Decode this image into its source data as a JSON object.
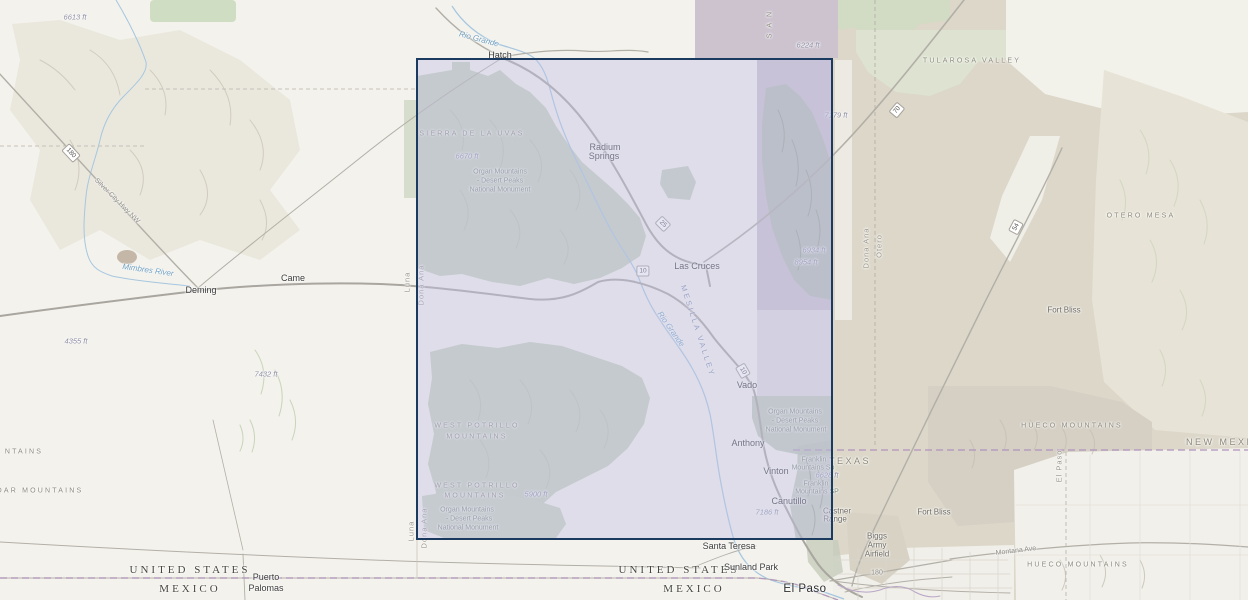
{
  "colors": {
    "selection_border": "#1b3a5f",
    "selection_fill": "rgba(192,192,229,0.42)",
    "label_city": "#3c3c3c",
    "label_country": "#47463e",
    "label_state": "#8d8779",
    "label_range": "#8d897c",
    "label_water": "#6f9fc0",
    "label_elev": "#8f8fa6",
    "label_park": "#7c8973",
    "label_county": "#9b978d",
    "road_gray": "#b2afa7",
    "boundary_purple": "#b195bd",
    "water_blue": "#a6c6e0"
  },
  "selection": {
    "x": 416,
    "y": 58,
    "width": 417,
    "height": 482
  },
  "map": {
    "labels": [
      {
        "text": "6613 ft",
        "x": 75,
        "y": 17,
        "cls": "elev",
        "name": "elevation-6613"
      },
      {
        "text": "180",
        "x": 71,
        "y": 153,
        "rot": 47,
        "cls": "shield",
        "name": "route-shield-180"
      },
      {
        "text": "Silver City Hwy NW",
        "x": 117,
        "y": 201,
        "rot": 45,
        "cls": "roadlbl",
        "name": "road-label-silver-city-hwy"
      },
      {
        "text": "Mimbres River",
        "x": 148,
        "y": 270,
        "rot": 8,
        "cls": "water",
        "name": "river-label-mimbres"
      },
      {
        "text": "Deming",
        "x": 201,
        "y": 290,
        "cls": "city",
        "name": "place-label-deming"
      },
      {
        "text": "Came",
        "x": 293,
        "y": 278,
        "cls": "city",
        "name": "place-label-came"
      },
      {
        "text": "4355 ft",
        "x": 76,
        "y": 341,
        "cls": "elev",
        "name": "elevation-4355"
      },
      {
        "text": "7432 ft",
        "x": 266,
        "y": 374,
        "cls": "elev",
        "name": "elevation-7432"
      },
      {
        "text": "NTAINS",
        "x": 24,
        "y": 452,
        "cls": "range",
        "name": "range-label-partial-mountains"
      },
      {
        "text": "DAR MOUNTAINS",
        "x": 40,
        "y": 491,
        "cls": "range",
        "name": "range-label-cedar-mountains"
      },
      {
        "text": "UNITED STATES",
        "x": 190,
        "y": 570,
        "cls": "country",
        "name": "country-label-united-states-west"
      },
      {
        "text": "MEXICO",
        "x": 190,
        "y": 589,
        "cls": "country",
        "name": "country-label-mexico-west"
      },
      {
        "text": "Puerto",
        "x": 266,
        "y": 577,
        "cls": "city",
        "name": "place-label-puerto-palomas-1"
      },
      {
        "text": "Palomas",
        "x": 266,
        "y": 588,
        "cls": "city",
        "name": "place-label-puerto-palomas-2"
      },
      {
        "text": "Rio Grande",
        "x": 479,
        "y": 39,
        "rot": 15,
        "cls": "water",
        "name": "river-label-rio-grande-north"
      },
      {
        "text": "Hatch",
        "x": 500,
        "y": 55,
        "cls": "city",
        "name": "place-label-hatch"
      },
      {
        "text": "SIERRA DE LA UVAS",
        "x": 472,
        "y": 134,
        "cls": "range",
        "name": "range-label-sierra-de-la-uvas"
      },
      {
        "text": "6670 ft",
        "x": 467,
        "y": 156,
        "cls": "elev",
        "name": "elevation-6670"
      },
      {
        "text": "Organ Mountains",
        "x": 500,
        "y": 172,
        "cls": "park",
        "name": "park-label-omdp-north-1"
      },
      {
        "text": "- Desert Peaks",
        "x": 500,
        "y": 181,
        "cls": "park",
        "name": "park-label-omdp-north-2"
      },
      {
        "text": "National Monument",
        "x": 500,
        "y": 190,
        "cls": "park",
        "name": "park-label-omdp-north-3"
      },
      {
        "text": "Radium",
        "x": 605,
        "y": 147,
        "cls": "city",
        "name": "place-label-radium-springs-1"
      },
      {
        "text": "Springs",
        "x": 604,
        "y": 156,
        "cls": "city",
        "name": "place-label-radium-springs-2"
      },
      {
        "text": "25",
        "x": 663,
        "y": 224,
        "rot": 45,
        "cls": "shield",
        "name": "route-shield-25"
      },
      {
        "text": "10",
        "x": 643,
        "y": 271,
        "cls": "shield",
        "name": "route-shield-10-west"
      },
      {
        "text": "Las Cruces",
        "x": 697,
        "y": 266,
        "cls": "city",
        "name": "place-label-las-cruces"
      },
      {
        "text": "Rio Grande",
        "x": 671,
        "y": 329,
        "rot": 55,
        "cls": "water",
        "name": "river-label-rio-grande-south"
      },
      {
        "text": "MESILLA VALLEY",
        "x": 698,
        "y": 331,
        "rot": 72,
        "cls": "valley",
        "name": "valley-label-mesilla"
      },
      {
        "text": "10",
        "x": 743,
        "y": 371,
        "rot": 60,
        "cls": "shield",
        "name": "route-shield-10-south"
      },
      {
        "text": "Vado",
        "x": 747,
        "y": 385,
        "cls": "city",
        "name": "place-label-vado"
      },
      {
        "text": "6934 ft",
        "x": 814,
        "y": 250,
        "cls": "elev",
        "name": "elevation-6934"
      },
      {
        "text": "8954 ft",
        "x": 806,
        "y": 262,
        "cls": "elev",
        "name": "elevation-8954"
      },
      {
        "text": "S A N",
        "x": 770,
        "y": 24,
        "rot": -90,
        "cls": "range",
        "name": "range-label-san-partial"
      },
      {
        "text": "6224 ft",
        "x": 808,
        "y": 45,
        "cls": "elev",
        "name": "elevation-6224"
      },
      {
        "text": "TULAROSA VALLEY",
        "x": 972,
        "y": 61,
        "cls": "range",
        "name": "valley-label-tularosa"
      },
      {
        "text": "7179 ft",
        "x": 836,
        "y": 115,
        "cls": "elev",
        "name": "elevation-7179"
      },
      {
        "text": "70",
        "x": 897,
        "y": 110,
        "rot": -50,
        "cls": "shield",
        "name": "route-shield-70"
      },
      {
        "text": "Dona Ana",
        "x": 866,
        "y": 248,
        "rot": -90,
        "cls": "county",
        "name": "county-label-dona-ana-east"
      },
      {
        "text": "Otero",
        "x": 879,
        "y": 246,
        "rot": -90,
        "cls": "county",
        "name": "county-label-otero"
      },
      {
        "text": "OTERO MESA",
        "x": 1141,
        "y": 216,
        "cls": "range",
        "name": "range-label-otero-mesa"
      },
      {
        "text": "Fort Bliss",
        "x": 1064,
        "y": 310,
        "cls": "place-gray",
        "name": "place-label-fort-bliss-north"
      },
      {
        "text": "54",
        "x": 1016,
        "y": 227,
        "rot": -62,
        "cls": "shield",
        "name": "route-shield-54"
      },
      {
        "text": "Luna",
        "x": 407,
        "y": 282,
        "rot": -90,
        "cls": "county",
        "name": "county-label-luna-mid"
      },
      {
        "text": "Dona Ana",
        "x": 421,
        "y": 285,
        "rot": -90,
        "cls": "county",
        "name": "county-label-dona-ana-mid"
      },
      {
        "text": "Luna",
        "x": 411,
        "y": 531,
        "rot": -90,
        "cls": "county",
        "name": "county-label-luna-south"
      },
      {
        "text": "Dona Ana",
        "x": 424,
        "y": 528,
        "rot": -90,
        "cls": "county",
        "name": "county-label-dona-ana-south"
      },
      {
        "text": "WEST POTRILLO",
        "x": 477,
        "y": 426,
        "cls": "range",
        "name": "range-label-west-potrillo-a1"
      },
      {
        "text": "MOUNTAINS",
        "x": 477,
        "y": 437,
        "cls": "range",
        "name": "range-label-west-potrillo-a2"
      },
      {
        "text": "WEST POTRILLO",
        "x": 477,
        "y": 486,
        "cls": "range",
        "name": "range-label-west-potrillo-b1"
      },
      {
        "text": "MOUNTAINS",
        "x": 475,
        "y": 496,
        "cls": "range",
        "name": "range-label-west-potrillo-b2"
      },
      {
        "text": "5900 ft",
        "x": 536,
        "y": 494,
        "cls": "elev",
        "name": "elevation-5900"
      },
      {
        "text": "Organ Mountains",
        "x": 467,
        "y": 510,
        "cls": "park",
        "name": "park-label-omdp-south-1"
      },
      {
        "text": "- Desert Peaks",
        "x": 469,
        "y": 519,
        "cls": "park",
        "name": "park-label-omdp-south-2"
      },
      {
        "text": "National Monument",
        "x": 468,
        "y": 528,
        "cls": "park",
        "name": "park-label-omdp-south-3"
      },
      {
        "text": "Organ Mountains",
        "x": 795,
        "y": 412,
        "cls": "park",
        "name": "park-label-omdp-east-1"
      },
      {
        "text": "- Desert Peaks",
        "x": 795,
        "y": 421,
        "cls": "park",
        "name": "park-label-omdp-east-2"
      },
      {
        "text": "National Monument",
        "x": 796,
        "y": 430,
        "cls": "park",
        "name": "park-label-omdp-east-3"
      },
      {
        "text": "Anthony",
        "x": 748,
        "y": 443,
        "cls": "city",
        "name": "place-label-anthony"
      },
      {
        "text": "Vinton",
        "x": 776,
        "y": 471,
        "cls": "city",
        "name": "place-label-vinton"
      },
      {
        "text": "Franklin",
        "x": 814,
        "y": 460,
        "cls": "park",
        "name": "park-label-franklin-a1"
      },
      {
        "text": "Mountains Sp",
        "x": 813,
        "y": 468,
        "cls": "park",
        "name": "park-label-franklin-a2"
      },
      {
        "text": "6628 ft",
        "x": 827,
        "y": 475,
        "cls": "elev",
        "name": "elevation-6628"
      },
      {
        "text": "Franklin",
        "x": 816,
        "y": 484,
        "cls": "park",
        "name": "park-label-franklin-b1"
      },
      {
        "text": "Mountains SP",
        "x": 817,
        "y": 492,
        "cls": "park",
        "name": "park-label-franklin-b2"
      },
      {
        "text": "TEXAS",
        "x": 850,
        "y": 461,
        "cls": "state",
        "name": "state-label-texas"
      },
      {
        "text": "Canutillo",
        "x": 789,
        "y": 501,
        "cls": "city",
        "name": "place-label-canutillo"
      },
      {
        "text": "7186 ft",
        "x": 767,
        "y": 512,
        "cls": "elev",
        "name": "elevation-7186"
      },
      {
        "text": "Castner",
        "x": 837,
        "y": 511,
        "cls": "place-gray",
        "name": "place-label-castner-range-1"
      },
      {
        "text": "Range",
        "x": 835,
        "y": 519,
        "cls": "place-gray",
        "name": "place-label-castner-range-2"
      },
      {
        "text": "Santa Teresa",
        "x": 729,
        "y": 546,
        "cls": "city",
        "name": "place-label-santa-teresa"
      },
      {
        "text": "UNITED STATES",
        "x": 679,
        "y": 570,
        "cls": "country",
        "name": "country-label-united-states-east"
      },
      {
        "text": "Sunland Park",
        "x": 751,
        "y": 567,
        "cls": "city",
        "name": "place-label-sunland-park"
      },
      {
        "text": "MEXICO",
        "x": 694,
        "y": 589,
        "cls": "country",
        "name": "country-label-mexico-east"
      },
      {
        "text": "El Paso",
        "x": 805,
        "y": 589,
        "cls": "city-lg",
        "name": "place-label-el-paso"
      },
      {
        "text": "Biggs",
        "x": 877,
        "y": 536,
        "cls": "place-gray",
        "name": "place-label-biggs-1"
      },
      {
        "text": "Army",
        "x": 877,
        "y": 545,
        "cls": "place-gray",
        "name": "place-label-biggs-2"
      },
      {
        "text": "Airfield",
        "x": 877,
        "y": 554,
        "cls": "place-gray",
        "name": "place-label-biggs-3"
      },
      {
        "text": "Fort Bliss",
        "x": 934,
        "y": 512,
        "cls": "place-gray",
        "name": "place-label-fort-bliss-south"
      },
      {
        "text": "180",
        "x": 877,
        "y": 573,
        "cls": "roadlbl",
        "name": "road-label-180"
      },
      {
        "text": "Montana Ave",
        "x": 1016,
        "y": 551,
        "rot": -7,
        "cls": "roadlbl",
        "name": "road-label-montana-ave"
      },
      {
        "text": "HUECO MOUNTAINS",
        "x": 1072,
        "y": 426,
        "cls": "range",
        "name": "range-label-hueco-north"
      },
      {
        "text": "NEW MEXICO",
        "x": 1228,
        "y": 442,
        "cls": "state",
        "name": "state-label-new-mexico"
      },
      {
        "text": "El Paso",
        "x": 1059,
        "y": 466,
        "rot": -90,
        "cls": "county",
        "name": "county-label-el-paso"
      },
      {
        "text": "HUECO MOUNTAINS",
        "x": 1078,
        "y": 565,
        "cls": "range",
        "name": "range-label-hueco-south"
      }
    ]
  }
}
